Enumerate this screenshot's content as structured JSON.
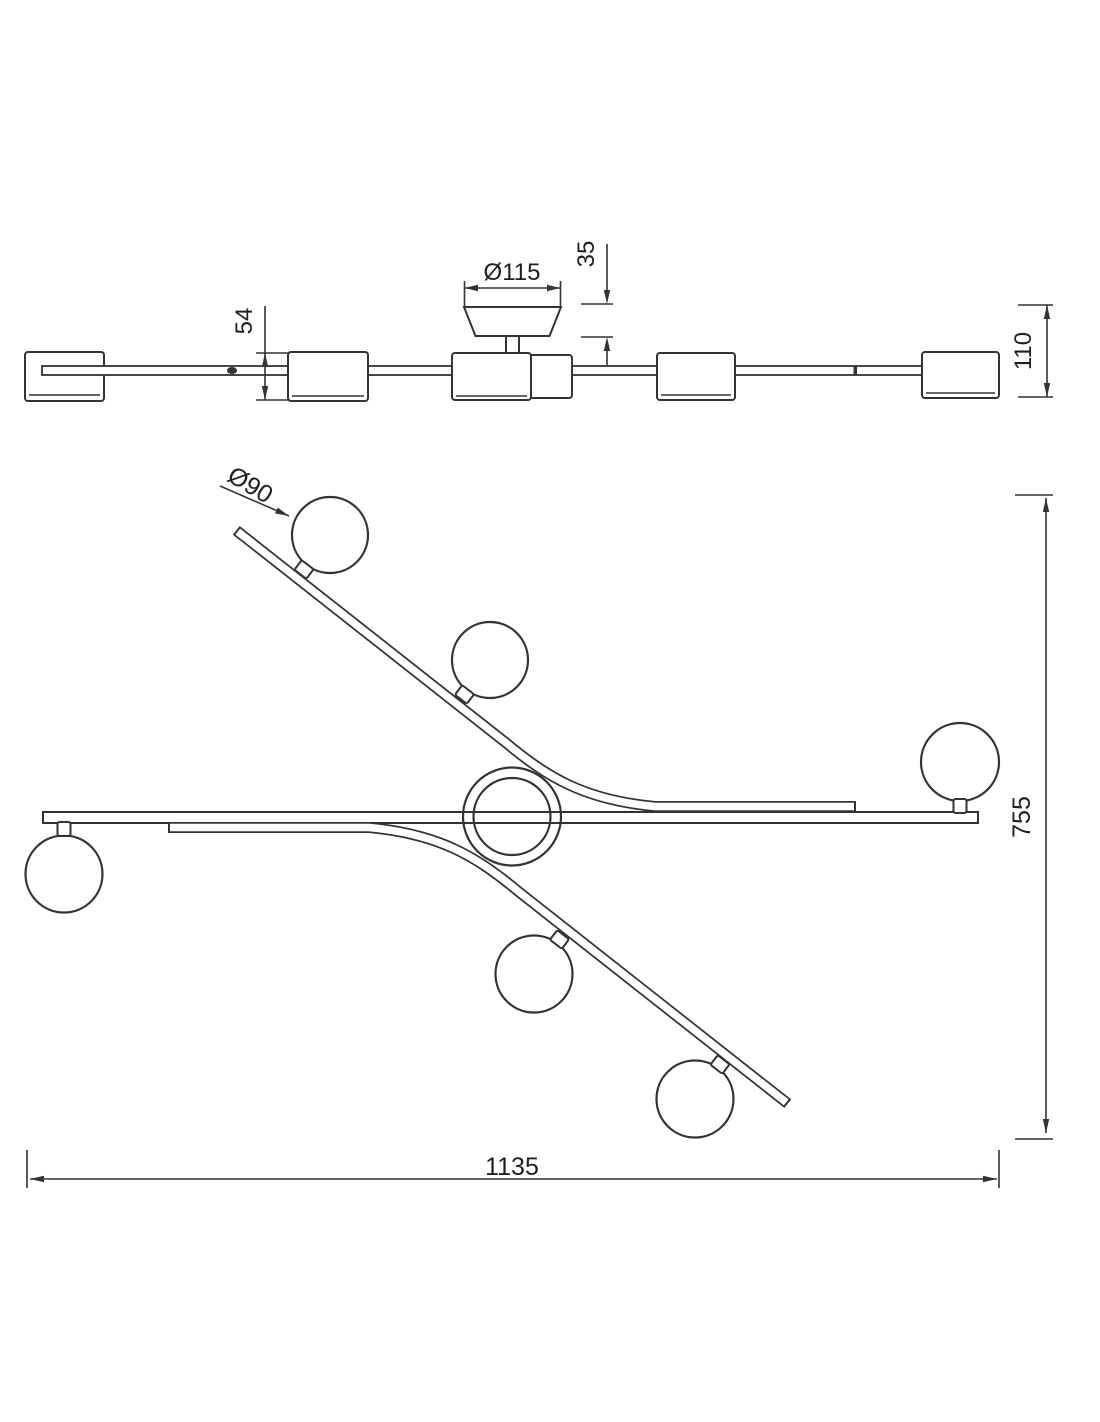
{
  "drawing": {
    "description": "Technical dimension drawing of a multi-globe ceiling light, side elevation and plan view",
    "colors": {
      "line": "#333333",
      "text": "#1f1f1f",
      "background": "#ffffff"
    },
    "side_view": {
      "dim_canopy_diameter": "Ø115",
      "dim_canopy_height": "35",
      "dim_shade_height": "54",
      "dim_total_height": "110"
    },
    "plan_view": {
      "dim_globe_diameter": "Ø90",
      "dim_overall_depth": "755",
      "dim_overall_width": "1135"
    }
  }
}
